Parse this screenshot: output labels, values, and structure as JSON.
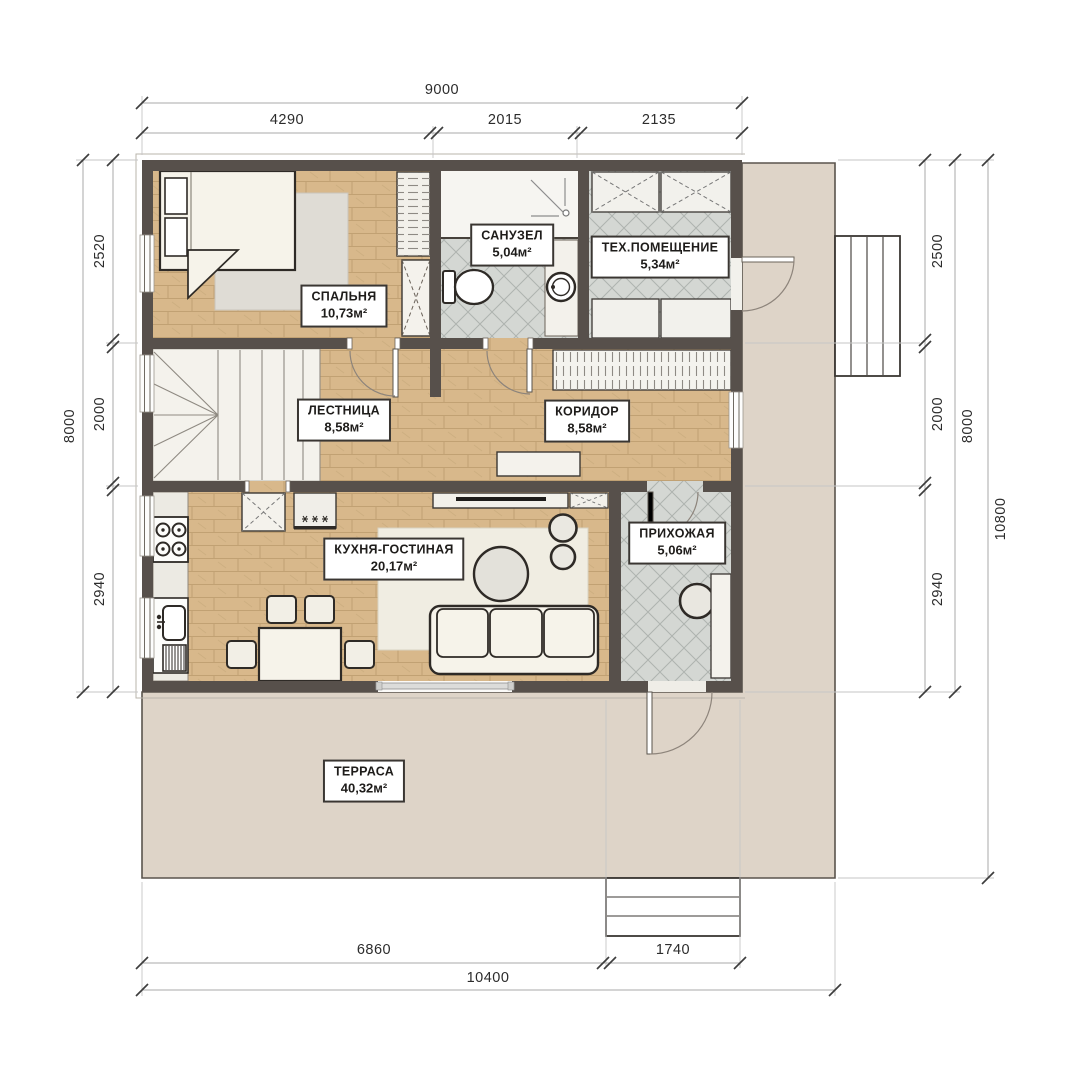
{
  "page": {
    "type": "architectural-floor-plan",
    "background": "#ffffff"
  },
  "rooms": {
    "bedroom": {
      "name": "СПАЛЬНЯ",
      "area": "10,73м²"
    },
    "bathroom": {
      "name": "САНУЗЕЛ",
      "area": "5,04м²"
    },
    "tech_room": {
      "name": "ТЕХ.ПОМЕЩЕНИЕ",
      "area": "5,34м²"
    },
    "stairs": {
      "name": "ЛЕСТНИЦА",
      "area": "8,58м²"
    },
    "corridor": {
      "name": "КОРИДОР",
      "area": "8,58м²"
    },
    "kitchen_living": {
      "name": "КУХНЯ-ГОСТИНАЯ",
      "area": "20,17м²"
    },
    "entry_hall": {
      "name": "ПРИХОЖАЯ",
      "area": "5,06м²"
    },
    "terrace": {
      "name": "ТЕРРАСА",
      "area": "40,32м²"
    }
  },
  "dims": {
    "top_total": "9000",
    "top_seg1": "4290",
    "top_seg2": "2015",
    "top_seg3": "2135",
    "left_total": "8000",
    "left_seg1": "2520",
    "left_seg2": "2000",
    "left_seg3": "2940",
    "right_seg1": "2500",
    "right_seg2": "2000",
    "right_seg3": "2940",
    "right_total": "8000",
    "right_overall": "10800",
    "bottom_seg1": "6860",
    "bottom_seg2": "1740",
    "bottom_total": "10400"
  },
  "colors": {
    "wall": "#57504b",
    "wood": "#d8b88b",
    "tile": "#d4d7d3",
    "terrace": "#ded4c8",
    "furniture_outline": "#2e2a26"
  }
}
